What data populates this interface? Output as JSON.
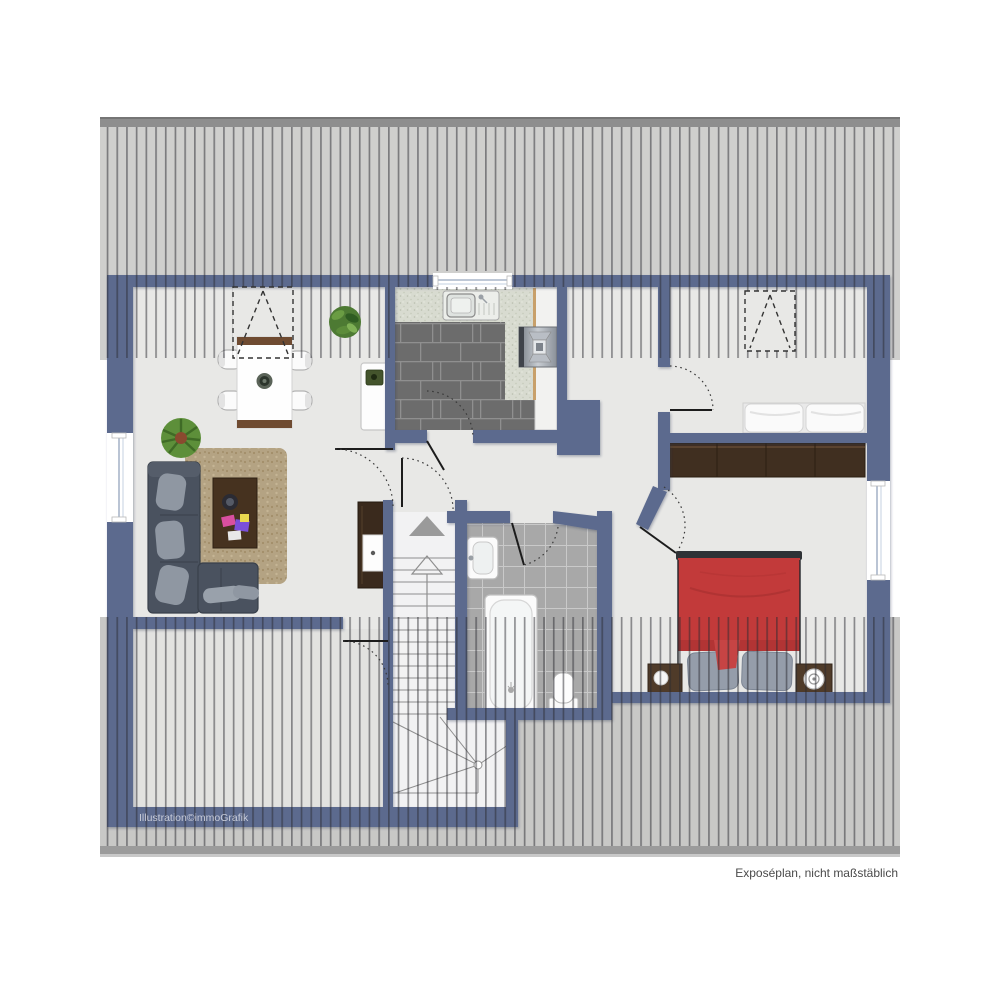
{
  "texts": {
    "watermark": "Illustration©immoGrafik",
    "disclaimer": "Exposéplan, nicht maßstäblich"
  },
  "colors": {
    "wall": "#5b6a8e",
    "floor": "#e8e8e6",
    "roof_background": "#cfcfcd",
    "roof_ridge": "#8e8e8e",
    "kitchen_tile": "#6c6c6c",
    "bath_tile": "#a8a8a8",
    "counter_speckle": "#d8dbd0",
    "bed_red": "#c23a3a",
    "sofa_gray": "#4a525f",
    "rug_beige": "#b4a383",
    "wood_dark": "#402f20",
    "stair_white": "#f2f2f3"
  },
  "icons": {
    "up_arrow": "stair-direction-up",
    "dormer_symbol": "dashed rectangle with triangle (roof window)",
    "door_swing": "dotted quarter arc"
  }
}
